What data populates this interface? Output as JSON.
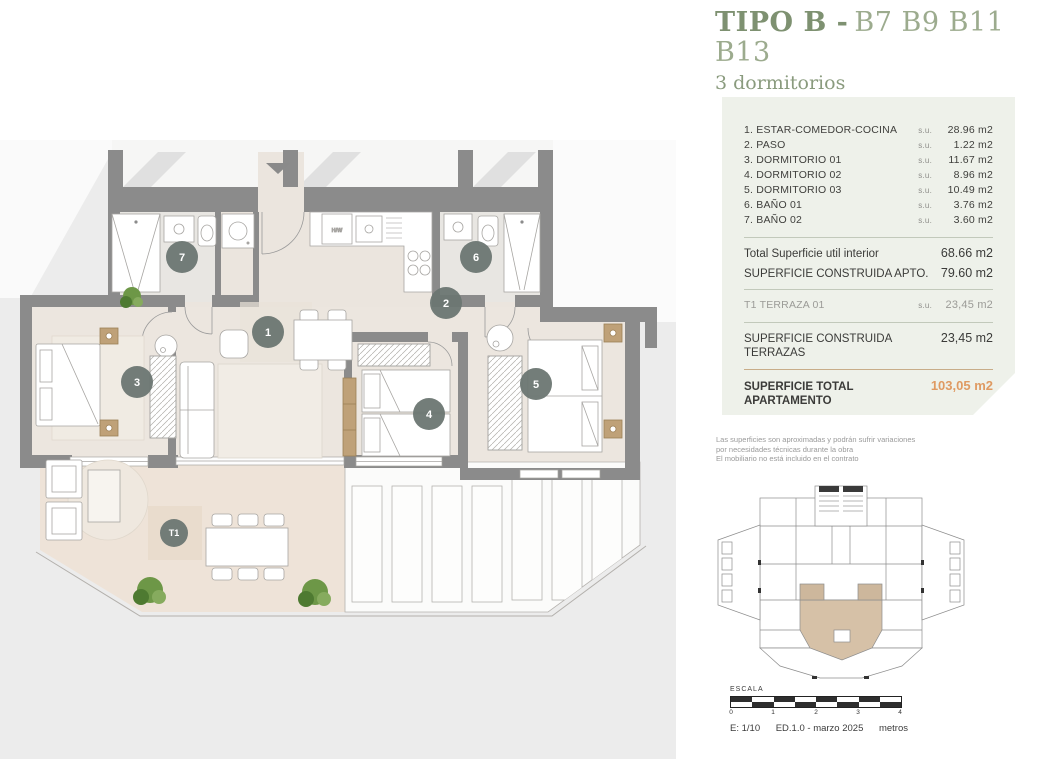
{
  "header": {
    "title_bold": "TIPO B -",
    "title_units": "B7 B9 B11 B13",
    "subtitle": "3 dormitorios"
  },
  "surface_card": {
    "rooms": [
      {
        "label": "1. ESTAR-COMEDOR-COCINA",
        "su": "s.u.",
        "value": "28.96 m2"
      },
      {
        "label": "2. PASO",
        "su": "s.u.",
        "value": "1.22 m2"
      },
      {
        "label": "3. DORMITORIO 01",
        "su": "s.u.",
        "value": "11.67 m2"
      },
      {
        "label": "4. DORMITORIO 02",
        "su": "s.u.",
        "value": "8.96 m2"
      },
      {
        "label": "5. DORMITORIO 03",
        "su": "s.u.",
        "value": "10.49 m2"
      },
      {
        "label": "6. BAÑO 01",
        "su": "s.u.",
        "value": "3.76 m2"
      },
      {
        "label": "7. BAÑO 02",
        "su": "s.u.",
        "value": "3.60 m2"
      }
    ],
    "totals": [
      {
        "label": "Total Superficie util interior",
        "value": "68.66 m2"
      },
      {
        "label": "SUPERFICIE CONSTRUIDA APTO.",
        "value": "79.60 m2"
      }
    ],
    "terrace_row": {
      "label": "T1 TERRAZA 01",
      "su": "s.u.",
      "value": "23,45 m2"
    },
    "terrace_total": {
      "label": "SUPERFICIE CONSTRUIDA TERRAZAS",
      "value": "23,45 m2"
    },
    "grand_total": {
      "label": "SUPERFICIE TOTAL APARTAMENTO",
      "value": "103,05 m2"
    }
  },
  "disclaimer": {
    "line1": "Las superficies son aproximadas y podrán sufrir variaciones",
    "line2": "por necesidades técnicas durante la obra",
    "line3": "El mobiliario no está incluido en el contrato"
  },
  "scale_bar": {
    "title": "ESCALA",
    "ticks": [
      "0",
      "1",
      "2",
      "3",
      "4"
    ],
    "scale": "E: 1/10",
    "edition": "ED.1.0 - marzo 2025",
    "unit": "metros"
  },
  "plan": {
    "badges": {
      "b1": "1",
      "b2": "2",
      "b3": "3",
      "b4": "4",
      "b5": "5",
      "b6": "6",
      "b7": "7",
      "t1": "T1"
    },
    "kitchen_label": "H/W"
  },
  "colors": {
    "accent_green": "#7e9171",
    "accent_green_light": "#9cab8e",
    "accent_orange": "#df9a62",
    "wall_gray": "#8b8b8b",
    "floor_beige": "#ece6df",
    "terrace_beige": "#eee3d8",
    "card_bg": "#eef1ea",
    "highlight_tan": "#d6c1a7"
  }
}
